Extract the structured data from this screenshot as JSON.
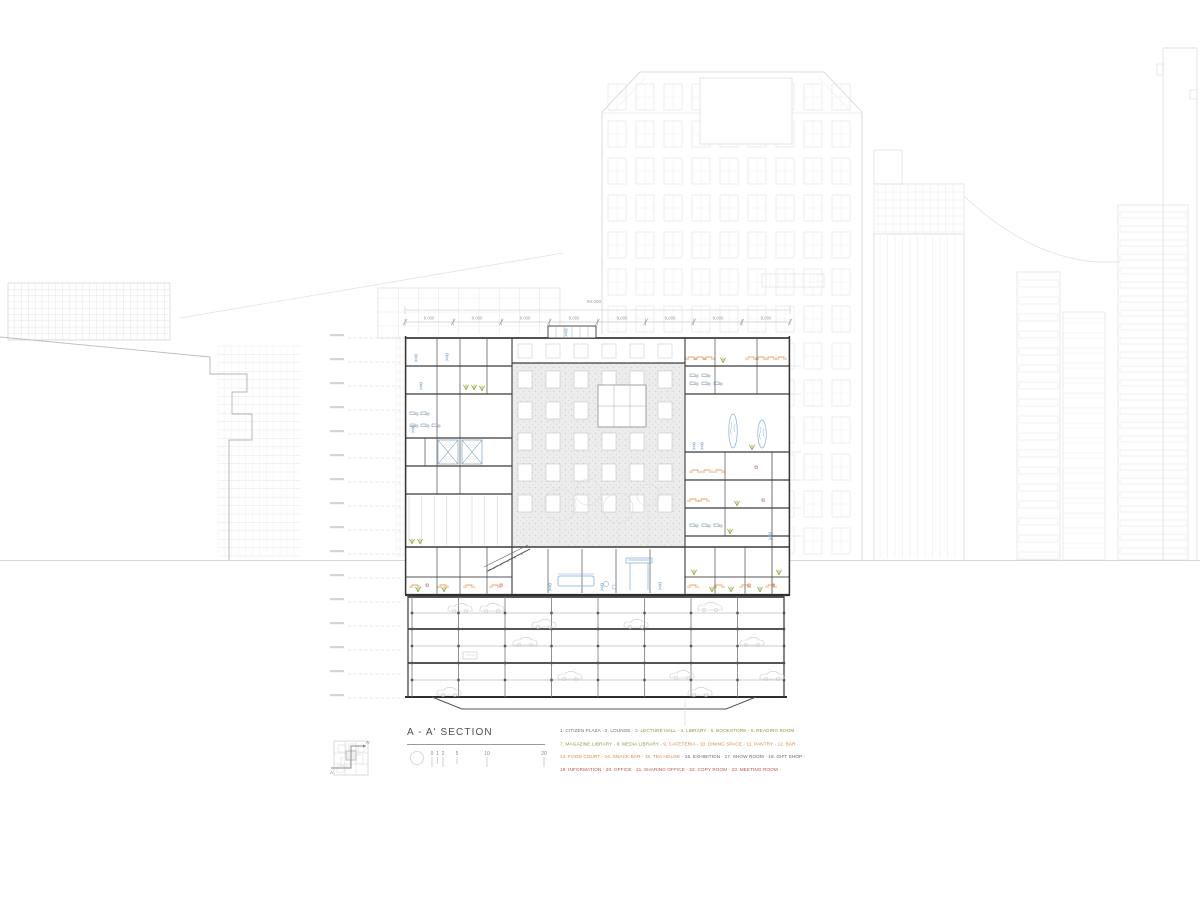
{
  "sheet": {
    "title": "A - A' SECTION",
    "keyplan": {
      "a": "A",
      "a_prime": "A'"
    },
    "scale_numbers": [
      "0",
      "1",
      "2",
      "5",
      "10",
      "20"
    ],
    "dimension": {
      "total": "64.000",
      "bays": [
        "8.000",
        "8.000",
        "8.000",
        "8.000",
        "8.000",
        "8.000",
        "8.000",
        "8.000"
      ]
    }
  },
  "legend": {
    "separator": "-",
    "groups": {
      "gray": "#6e6e6e",
      "green": "#8a9a3d",
      "orange": "#d9863c",
      "dark": "#5f6672",
      "red": "#b5544a"
    },
    "lines": [
      [
        {
          "num": "1.",
          "label": "CITIZEN PLAZA",
          "group": "gray"
        },
        {
          "num": "2.",
          "label": "LOUNGE",
          "group": "gray"
        },
        {
          "num": "3.",
          "label": "LECTURE HALL",
          "group": "green"
        },
        {
          "num": "4.",
          "label": "LIBRARY",
          "group": "green"
        },
        {
          "num": "5.",
          "label": "BOOKSTORE",
          "group": "green"
        },
        {
          "num": "6.",
          "label": "READING ROOM",
          "group": "green"
        }
      ],
      [
        {
          "num": "7.",
          "label": "MAGAZINE LIBRARY",
          "group": "green"
        },
        {
          "num": "8.",
          "label": "MEDIA LIBRARY",
          "group": "green"
        },
        {
          "num": "9.",
          "label": "CAFETERIA",
          "group": "orange"
        },
        {
          "num": "10.",
          "label": "DINING SPACE",
          "group": "orange"
        },
        {
          "num": "11.",
          "label": "PANTRY",
          "group": "orange"
        },
        {
          "num": "12.",
          "label": "BAR",
          "group": "orange"
        }
      ],
      [
        {
          "num": "13.",
          "label": "FOOD COURT",
          "group": "orange"
        },
        {
          "num": "14.",
          "label": "SNACK BAR",
          "group": "orange"
        },
        {
          "num": "15.",
          "label": "TEA HOUSE",
          "group": "orange"
        },
        {
          "num": "16.",
          "label": "EXHIBITION",
          "group": "dark"
        },
        {
          "num": "17.",
          "label": "SHOW ROOM",
          "group": "dark"
        },
        {
          "num": "18.",
          "label": "GIFT SHOP",
          "group": "dark"
        }
      ],
      [
        {
          "num": "19.",
          "label": "INFORMATION",
          "group": "red"
        },
        {
          "num": "20.",
          "label": "OFFICE",
          "group": "red"
        },
        {
          "num": "21.",
          "label": "SHARING OFFICE",
          "group": "red"
        },
        {
          "num": "22.",
          "label": "COPY ROOM",
          "group": "red"
        },
        {
          "num": "23.",
          "label": "MEETING ROOM",
          "group": "red"
        }
      ]
    ]
  },
  "palette": {
    "blue": "#85aed6",
    "green": "#8fae3e",
    "orange": "#e0883e",
    "red": "#c4554a",
    "line_dark": "#3a3a3a",
    "line_bg": "#d9d9d9"
  }
}
